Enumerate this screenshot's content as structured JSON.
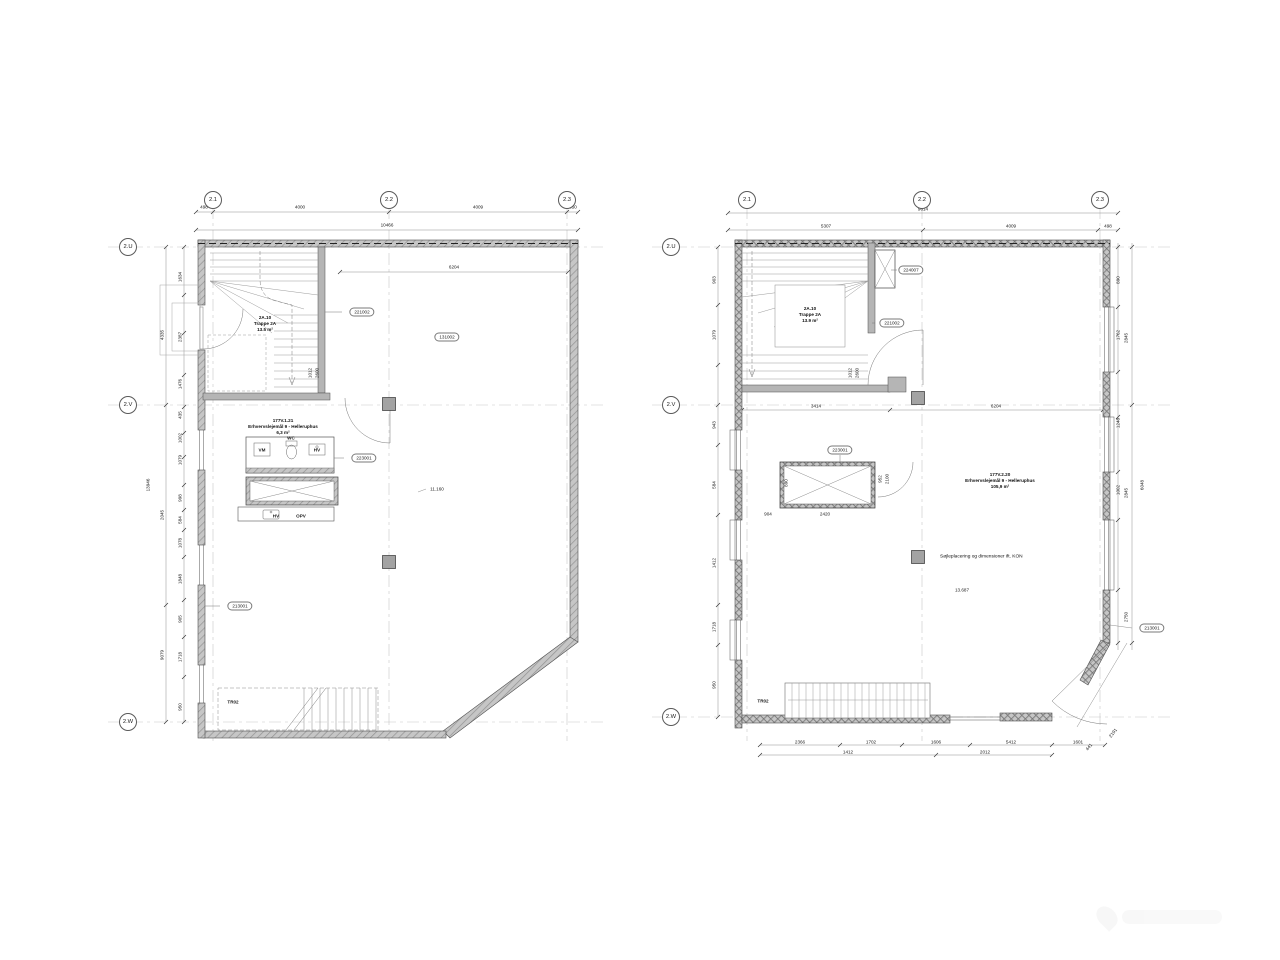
{
  "plans": [
    {
      "grid_cols": [
        "2.1",
        "2.2",
        "2.3"
      ],
      "grid_rows": [
        "2.U",
        "2.V",
        "2.W"
      ],
      "top_total": "10466",
      "top_dims": [
        "498",
        "4000",
        "4009",
        "350"
      ],
      "dim_6204": "6204",
      "dim_11160": "11.160",
      "stair_room": {
        "id": "2A.10",
        "name": "Trappe 2A",
        "area": "13.5 m²"
      },
      "wc_room": {
        "id": "177V.1.21",
        "name": "Erhvervslejemål 9 - Helleruphus",
        "area": "6,3 m²"
      },
      "tags": {
        "t221002": "221002",
        "t131002": "131002",
        "t223001": "223001",
        "t213001": "213001"
      },
      "fixtures": {
        "vm": "VM",
        "wc": "WC",
        "hv": "HV",
        "hv2": "HV",
        "opv": "OPV"
      },
      "lower_stair": "TR02",
      "side_dims_inner": [
        "1634",
        "2387",
        "1476",
        "435",
        "1002",
        "1079",
        "998",
        "584",
        "1078",
        "1848",
        "905",
        "1718",
        "950"
      ],
      "side_dims_outer": [
        "4335",
        "2045",
        "9079"
      ],
      "side_total": "13946",
      "stair_dims": [
        "1012",
        "2600"
      ]
    },
    {
      "grid_cols": [
        "2.1",
        "2.2",
        "2.3"
      ],
      "grid_rows": [
        "2.U",
        "2.V",
        "2.W"
      ],
      "top_total": "9814",
      "top_dims": [
        "5307",
        "4009",
        "498"
      ],
      "interior_dims": [
        "3414",
        "6204"
      ],
      "stair_room": {
        "id": "2A.10",
        "name": "Trappe 2A",
        "area": "13.9 m²"
      },
      "main_room": {
        "id": "177V.2.20",
        "name": "Erhvervslejemål 9 - Helleruphus",
        "area": "105,9 m²"
      },
      "note": "Søjleplacering og dimensioner ift. KON",
      "floor_dim": "13.687",
      "tags": {
        "t224007": "224007",
        "t221002": "221002",
        "t223001": "223001",
        "t213001": "213001"
      },
      "lower_stair": "TR02",
      "shaft_dims": [
        "890",
        "904",
        "2420",
        "952",
        "2100"
      ],
      "stair_dims": [
        "1012",
        "2600"
      ],
      "bottom_dims": [
        "2366",
        "1702",
        "1606",
        "5412",
        "1601"
      ],
      "bottom_dims2": [
        "1412",
        "2012"
      ],
      "corner_dims": [
        "441",
        "2191"
      ],
      "right_dims": [
        "890",
        "1762",
        "2845",
        "1248",
        "1002",
        "2845",
        "2750",
        "6048"
      ],
      "left_dims": [
        "903",
        "1079",
        "943",
        "584",
        "1412",
        "1718",
        "950"
      ]
    }
  ]
}
